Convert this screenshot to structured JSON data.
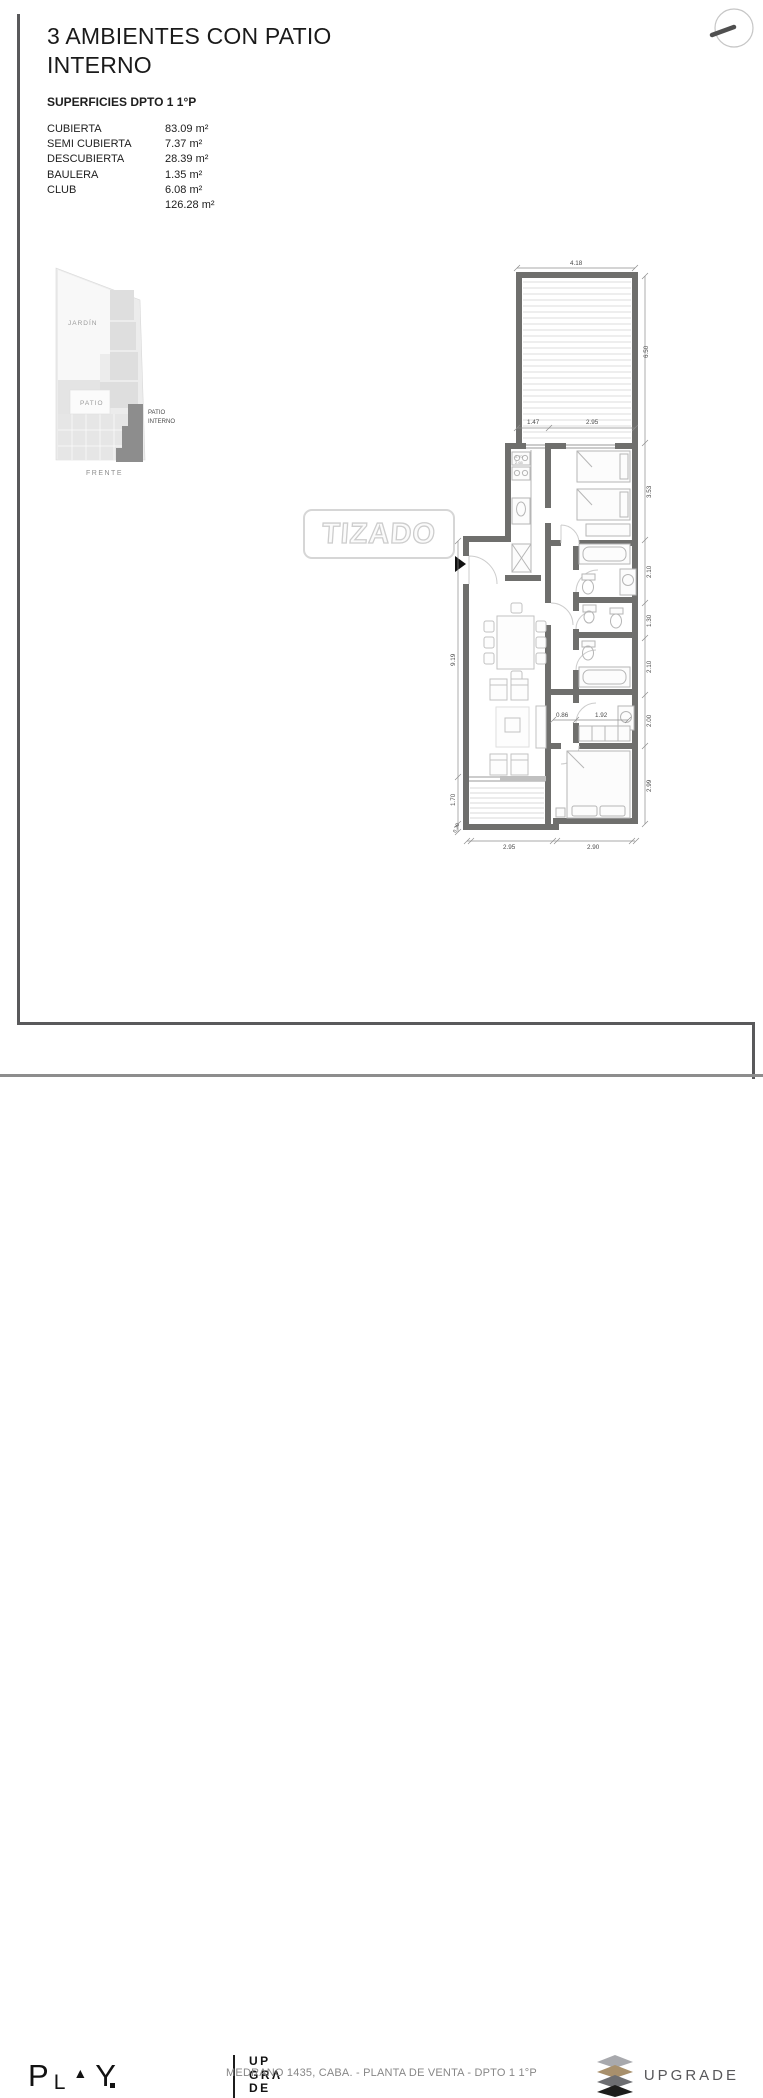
{
  "header": {
    "title_line1": "3 AMBIENTES CON PATIO",
    "title_line2": "INTERNO",
    "surfaces_title": "SUPERFICIES DPTO 1 1°P"
  },
  "surfaces": {
    "rows": [
      {
        "label": "CUBIERTA",
        "value": "83.09 m²"
      },
      {
        "label": "SEMI CUBIERTA",
        "value": "7.37 m²"
      },
      {
        "label": "DESCUBIERTA",
        "value": "28.39 m²"
      },
      {
        "label": "BAULERA",
        "value": "1.35 m²"
      },
      {
        "label": "CLUB",
        "value": "6.08 m²"
      },
      {
        "label": "",
        "value": "126.28 m²"
      }
    ]
  },
  "site": {
    "jardin": "JARDÍN",
    "patio": "PATIO",
    "pi1": "PATIO",
    "pi2": "INTERNO",
    "frente": "FRENTE"
  },
  "watermark": {
    "text": "TIZADO"
  },
  "plan": {
    "dims": {
      "top": "4.18",
      "right_total": "6.50",
      "tb1": "1.47",
      "tb2": "2.95",
      "r1": "3.53",
      "r2": "2.10",
      "r3": "1.30",
      "r4": "2.10",
      "r5": "2.00",
      "r6": "2.99",
      "l1": "9.19",
      "l2": "1.70",
      "l3": "0.30",
      "m1": "0.86",
      "m2": "1.92",
      "b1": "2.95",
      "b2": "2.90",
      "k1": "0.70",
      "k2": "2.65"
    }
  },
  "footer": {
    "play_p": "P",
    "play_l": "L",
    "play_tri": "▲",
    "play_y": "Y",
    "up1": "UP",
    "up2": "GRΛ",
    "up3": "DE",
    "center": "MEDRANO 1435, CABA. - PLANTA DE VENTA -  DPTO 1 1°P",
    "upgrade": "UPGRADE"
  }
}
